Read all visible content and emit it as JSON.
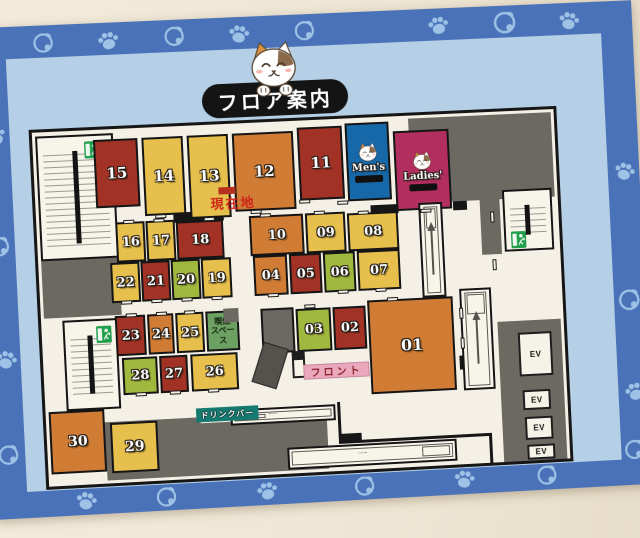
{
  "labels": {
    "title": "フロア案内",
    "current_location": "現在地",
    "front_desk": "フロント",
    "drink_bar": "ドリンクバー",
    "smoking_lines": [
      "喫煙",
      "スペース"
    ],
    "mens": "Men's",
    "ladies": "Ladies'",
    "ev": "EV"
  },
  "palette": {
    "red": "#a33226",
    "yellow": "#e6bf4c",
    "orange": "#d07c35",
    "green": "#a0b83e",
    "smokegreen": "#6da163",
    "blue": "#1668a8",
    "magenta": "#b12e5e",
    "gray": "#6c6862",
    "black": "#161616",
    "floor": "#f4f0e5",
    "teal": "#157a70",
    "pink": "#eba8bc",
    "deco": "#9dc2e6",
    "border_blue": "#4a72b8",
    "inner_blue": "#b5d0e6",
    "current_red": "#cf2418",
    "sign_green": "#1f9e4b"
  },
  "border_icons": [
    {
      "icon": "bell-icon",
      "x": 58,
      "y": 5
    },
    {
      "icon": "paw-icon",
      "x": 122,
      "y": 6,
      "rot": -10
    },
    {
      "icon": "bell-icon",
      "x": 188,
      "y": 4
    },
    {
      "icon": "paw-icon",
      "x": 252,
      "y": 5,
      "rot": 8
    },
    {
      "icon": "bell-icon",
      "x": 318,
      "y": 4
    },
    {
      "icon": "paw-icon",
      "x": 452,
      "y": 5,
      "rot": -8
    },
    {
      "icon": "bell-icon",
      "x": 518,
      "y": 3,
      "s": 27
    },
    {
      "icon": "paw-icon",
      "x": 584,
      "y": 6,
      "rot": 10
    },
    {
      "icon": "paw-icon",
      "x": 6,
      "y": 96,
      "rot": -20
    },
    {
      "icon": "bell-icon",
      "x": 5,
      "y": 205
    },
    {
      "icon": "paw-icon",
      "x": 6,
      "y": 318,
      "rot": 15
    },
    {
      "icon": "bell-icon",
      "x": 4,
      "y": 412
    },
    {
      "icon": "paw-icon",
      "x": 633,
      "y": 160,
      "rot": 15
    },
    {
      "icon": "bell-icon",
      "x": 631,
      "y": 288,
      "s": 26
    },
    {
      "icon": "paw-icon",
      "x": 633,
      "y": 382,
      "rot": -12
    },
    {
      "icon": "bell-icon",
      "x": 630,
      "y": 440
    },
    {
      "icon": "paw-icon",
      "x": 78,
      "y": 462,
      "rot": 12
    },
    {
      "icon": "bell-icon",
      "x": 158,
      "y": 462
    },
    {
      "icon": "paw-icon",
      "x": 258,
      "y": 462,
      "rot": -10
    },
    {
      "icon": "bell-icon",
      "x": 356,
      "y": 462
    },
    {
      "icon": "paw-icon",
      "x": 456,
      "y": 461,
      "rot": 8
    },
    {
      "icon": "bell-icon",
      "x": 540,
      "y": 461
    }
  ],
  "map": {
    "x": 51,
    "y": 103,
    "w": 522,
    "h": 352,
    "elements": [
      {
        "t": "wall",
        "n": "corridor-wall-top-right",
        "x": 415,
        "y": 3,
        "w": 104,
        "h": 85
      },
      {
        "t": "wall",
        "n": "corridor-wall-above-ladies",
        "x": 375,
        "y": 3,
        "w": 40,
        "h": 13
      },
      {
        "t": "wall",
        "n": "corridor-wall-right-strip",
        "x": 443,
        "y": 88,
        "w": 20,
        "h": 55
      },
      {
        "t": "wall",
        "n": "corridor-wall-left",
        "x": 3,
        "y": 128,
        "w": 77,
        "h": 57
      },
      {
        "t": "wall",
        "n": "corridor-wall-bottom-left",
        "x": 58,
        "y": 291,
        "w": 95,
        "h": 58
      },
      {
        "t": "wall",
        "n": "corridor-wall-bottom",
        "x": 149,
        "y": 297,
        "w": 130,
        "h": 52
      },
      {
        "t": "wall",
        "n": "elevator-hall-wall",
        "x": 455,
        "y": 211,
        "w": 64,
        "h": 141
      },
      {
        "t": "wall",
        "c": "black",
        "n": "wall-segment",
        "x": 136,
        "y": 86,
        "w": 50,
        "h": 10
      },
      {
        "t": "wall",
        "c": "black",
        "n": "wall-segment",
        "x": 333,
        "y": 88,
        "w": 28,
        "h": 9
      },
      {
        "t": "wall",
        "c": "black",
        "n": "wall-segment",
        "x": 416,
        "y": 88,
        "w": 14,
        "h": 9
      },
      {
        "t": "wall",
        "c": "black",
        "n": "wall-segment",
        "x": 415,
        "y": 243,
        "w": 14,
        "h": 14
      },
      {
        "t": "wall",
        "c": "black",
        "n": "wall-step",
        "x": 290,
        "y": 315,
        "w": 23,
        "h": 10
      },
      {
        "t": "wall",
        "c": "black",
        "n": "wall-segment",
        "x": 290,
        "y": 283,
        "w": 3,
        "h": 34
      },
      {
        "t": "wall",
        "c": "black",
        "n": "wall-segment",
        "x": 313,
        "y": 322,
        "w": 131,
        "h": 3
      },
      {
        "t": "wall",
        "c": "black",
        "n": "wall-segment",
        "x": 441,
        "y": 322,
        "w": 3,
        "h": 30
      },
      {
        "t": "stair",
        "n": "stairwell-top-left",
        "x": 3,
        "y": 4,
        "w": 77,
        "h": 124,
        "sign": {
          "x": 46,
          "y": 5
        }
      },
      {
        "t": "stair",
        "n": "stairwell-left",
        "x": 21,
        "y": 188,
        "w": 54,
        "h": 90,
        "sign": {
          "x": 31,
          "y": 5
        }
      },
      {
        "t": "stair",
        "n": "stairwell-right",
        "x": 466,
        "y": 79,
        "w": 50,
        "h": 62,
        "sign": {
          "x": 5,
          "y": 40
        }
      },
      {
        "t": "room",
        "n": "room-15",
        "label": "15",
        "c": "red",
        "x": 60,
        "y": 10,
        "w": 44,
        "h": 68,
        "fs": 15
      },
      {
        "t": "room",
        "n": "room-14",
        "label": "14",
        "c": "yellow",
        "x": 108,
        "y": 10,
        "w": 41,
        "h": 78,
        "fs": 15
      },
      {
        "t": "room",
        "n": "room-13",
        "label": "13",
        "c": "yellow",
        "x": 153,
        "y": 10,
        "w": 41,
        "h": 83,
        "fs": 15
      },
      {
        "t": "room",
        "n": "room-12",
        "label": "12",
        "c": "orange",
        "x": 198,
        "y": 10,
        "w": 61,
        "h": 78,
        "fs": 15
      },
      {
        "t": "room",
        "n": "room-11",
        "label": "11",
        "c": "red",
        "x": 263,
        "y": 7,
        "w": 45,
        "h": 73,
        "fs": 15
      },
      {
        "t": "room",
        "n": "room-mens",
        "special": "cat",
        "label": "Men's",
        "c": "blue",
        "x": 311,
        "y": 5,
        "w": 44,
        "h": 78
      },
      {
        "t": "room",
        "n": "room-ladies",
        "special": "cat",
        "label": "Ladies'",
        "c": "magenta",
        "x": 359,
        "y": 15,
        "w": 56,
        "h": 80
      },
      {
        "t": "room",
        "n": "room-16",
        "label": "16",
        "c": "yellow",
        "x": 78,
        "y": 93,
        "w": 29,
        "h": 40
      },
      {
        "t": "room",
        "n": "room-17",
        "label": "17",
        "c": "yellow",
        "x": 108,
        "y": 93,
        "w": 29,
        "h": 40
      },
      {
        "t": "room",
        "n": "room-18",
        "label": "18",
        "c": "red",
        "x": 138,
        "y": 95,
        "w": 47,
        "h": 38
      },
      {
        "t": "room",
        "n": "room-22",
        "label": "22",
        "c": "yellow",
        "x": 71,
        "y": 133,
        "w": 29,
        "h": 40
      },
      {
        "t": "room",
        "n": "room-21",
        "label": "21",
        "c": "red",
        "x": 101,
        "y": 133,
        "w": 29,
        "h": 40
      },
      {
        "t": "room",
        "n": "room-20",
        "label": "20",
        "c": "green",
        "x": 131,
        "y": 133,
        "w": 29,
        "h": 40
      },
      {
        "t": "room",
        "n": "room-19",
        "label": "19",
        "c": "yellow",
        "x": 161,
        "y": 133,
        "w": 30,
        "h": 40
      },
      {
        "t": "room",
        "n": "room-10",
        "label": "10",
        "c": "orange",
        "x": 211,
        "y": 93,
        "w": 54,
        "h": 40
      },
      {
        "t": "room",
        "n": "room-09",
        "label": "09",
        "c": "yellow",
        "x": 267,
        "y": 93,
        "w": 40,
        "h": 40
      },
      {
        "t": "room",
        "n": "room-08",
        "label": "08",
        "c": "yellow",
        "x": 309,
        "y": 95,
        "w": 51,
        "h": 38
      },
      {
        "t": "room",
        "n": "room-04",
        "label": "04",
        "c": "orange",
        "x": 213,
        "y": 133,
        "w": 34,
        "h": 40
      },
      {
        "t": "room",
        "n": "room-05",
        "label": "05",
        "c": "red",
        "x": 249,
        "y": 133,
        "w": 32,
        "h": 40
      },
      {
        "t": "room",
        "n": "room-06",
        "label": "06",
        "c": "green",
        "x": 283,
        "y": 133,
        "w": 32,
        "h": 40
      },
      {
        "t": "room",
        "n": "room-07",
        "label": "07",
        "c": "yellow",
        "x": 317,
        "y": 133,
        "w": 43,
        "h": 40
      },
      {
        "t": "room",
        "n": "room-23",
        "label": "23",
        "c": "red",
        "x": 73,
        "y": 186,
        "w": 30,
        "h": 40
      },
      {
        "t": "room",
        "n": "room-24",
        "label": "24",
        "c": "orange",
        "x": 105,
        "y": 186,
        "w": 26,
        "h": 40
      },
      {
        "t": "room",
        "n": "room-25",
        "label": "25",
        "c": "yellow",
        "x": 133,
        "y": 186,
        "w": 28,
        "h": 40
      },
      {
        "t": "room",
        "n": "smoking-area",
        "c": "smokegreen",
        "x": 163,
        "y": 186,
        "w": 33,
        "h": 40,
        "smoking": true
      },
      {
        "t": "wall",
        "n": "smoking-corner-wall",
        "x": 181,
        "y": 184,
        "w": 15,
        "h": 14
      },
      {
        "t": "room",
        "n": "room-28",
        "label": "28",
        "c": "green",
        "x": 78,
        "y": 228,
        "w": 35,
        "h": 37
      },
      {
        "t": "room",
        "n": "room-27",
        "label": "27",
        "c": "red",
        "x": 115,
        "y": 228,
        "w": 28,
        "h": 37
      },
      {
        "t": "room",
        "n": "room-26",
        "label": "26",
        "c": "yellow",
        "x": 146,
        "y": 228,
        "w": 47,
        "h": 37
      },
      {
        "t": "room",
        "n": "service-room",
        "c": "gray",
        "x": 218,
        "y": 186,
        "w": 33,
        "h": 45
      },
      {
        "t": "room",
        "n": "room-03",
        "label": "03",
        "c": "green",
        "x": 253,
        "y": 188,
        "w": 35,
        "h": 43
      },
      {
        "t": "room",
        "n": "room-02",
        "label": "02",
        "c": "red",
        "x": 290,
        "y": 188,
        "w": 33,
        "h": 43
      },
      {
        "t": "room",
        "n": "room-01",
        "label": "01",
        "c": "orange",
        "x": 325,
        "y": 183,
        "w": 86,
        "h": 94,
        "fs": 16
      },
      {
        "t": "room",
        "n": "room-30",
        "label": "30",
        "c": "orange",
        "x": 3,
        "y": 278,
        "w": 55,
        "h": 62,
        "fs": 14
      },
      {
        "t": "room",
        "n": "room-29",
        "label": "29",
        "c": "yellow",
        "x": 63,
        "y": 292,
        "w": 47,
        "h": 50,
        "fs": 14
      },
      {
        "t": "esc",
        "n": "escalator-mid",
        "x": 381,
        "y": 88,
        "w": 24,
        "h": 95,
        "dir": "up"
      },
      {
        "t": "esc",
        "n": "escalator-right",
        "x": 418,
        "y": 176,
        "w": 32,
        "h": 102,
        "dir": "up"
      },
      {
        "t": "esc",
        "n": "escalator-bottom-upper",
        "x": 183,
        "y": 285,
        "w": 105,
        "h": 16,
        "dir": "left"
      },
      {
        "t": "esc",
        "n": "escalator-bottom-lower",
        "x": 238,
        "y": 326,
        "w": 170,
        "h": 22,
        "dir": "right"
      },
      {
        "t": "ev",
        "n": "elevator-1",
        "x": 475,
        "y": 223,
        "w": 34,
        "h": 44
      },
      {
        "t": "ev",
        "n": "elevator-2",
        "x": 477,
        "y": 281,
        "w": 28,
        "h": 20
      },
      {
        "t": "ev",
        "n": "elevator-3",
        "x": 478,
        "y": 308,
        "w": 28,
        "h": 23
      },
      {
        "t": "ev",
        "n": "elevator-4",
        "x": 479,
        "y": 336,
        "w": 28,
        "h": 15
      },
      {
        "t": "counter",
        "n": "front-counter",
        "x": 212,
        "y": 222,
        "w": 26,
        "h": 42
      },
      {
        "t": "machine",
        "n": "kiosk-machine",
        "x": 247,
        "y": 230,
        "w": 13,
        "h": 27
      },
      {
        "t": "label",
        "n": "drink-bar-label",
        "key": "drink_bar",
        "cls": "lab-drink",
        "x": 149,
        "y": 282,
        "w": 62,
        "h": 14
      },
      {
        "t": "label",
        "n": "front-desk-label",
        "key": "front_desk",
        "cls": "lab-front",
        "x": 258,
        "y": 244,
        "w": 66,
        "h": 15
      },
      {
        "t": "marker",
        "n": "current-location-marker",
        "x": 182,
        "y": 63,
        "w": 17,
        "h": 7
      },
      {
        "t": "label",
        "n": "current-location-label",
        "key": "current_location",
        "cls": "lab-genzai",
        "x": 168,
        "y": 70,
        "w": 56,
        "h": 16
      },
      {
        "t": "notch",
        "n": "door-notch",
        "x": 118,
        "y": 87
      },
      {
        "t": "notch",
        "n": "door-notch",
        "x": 166,
        "y": 92
      },
      {
        "t": "notch",
        "n": "door-notch",
        "x": 213,
        "y": 87
      },
      {
        "t": "notch",
        "n": "door-notch",
        "x": 262,
        "y": 79
      },
      {
        "t": "notch",
        "n": "door-notch",
        "x": 300,
        "y": 82
      },
      {
        "t": "notch",
        "n": "door-notch",
        "x": 383,
        "y": 94
      },
      {
        "t": "notch",
        "n": "door-notch",
        "x": 86,
        "y": 91
      },
      {
        "t": "notch",
        "n": "door-notch",
        "x": 116,
        "y": 91
      },
      {
        "t": "notch",
        "n": "door-notch",
        "x": 80,
        "y": 171
      },
      {
        "t": "notch",
        "n": "door-notch",
        "x": 110,
        "y": 171
      },
      {
        "t": "notch",
        "n": "door-notch",
        "x": 140,
        "y": 171
      },
      {
        "t": "notch",
        "n": "door-notch",
        "x": 170,
        "y": 171
      },
      {
        "t": "notch",
        "n": "door-notch",
        "x": 222,
        "y": 91
      },
      {
        "t": "notch",
        "n": "door-notch",
        "x": 276,
        "y": 91
      },
      {
        "t": "notch",
        "n": "door-notch",
        "x": 320,
        "y": 93
      },
      {
        "t": "notch",
        "n": "door-notch",
        "x": 226,
        "y": 171
      },
      {
        "t": "notch",
        "n": "door-notch",
        "x": 296,
        "y": 171
      },
      {
        "t": "notch",
        "n": "door-notch",
        "x": 334,
        "y": 171
      },
      {
        "t": "notch",
        "n": "door-notch",
        "x": 84,
        "y": 184
      },
      {
        "t": "notch",
        "n": "door-notch",
        "x": 114,
        "y": 184
      },
      {
        "t": "notch",
        "n": "door-notch",
        "x": 142,
        "y": 184
      },
      {
        "t": "notch",
        "n": "door-notch",
        "x": 90,
        "y": 263
      },
      {
        "t": "notch",
        "n": "door-notch",
        "x": 124,
        "y": 263
      },
      {
        "t": "notch",
        "n": "door-notch",
        "x": 162,
        "y": 263
      },
      {
        "t": "notch",
        "n": "door-notch",
        "x": 262,
        "y": 184
      },
      {
        "t": "notch",
        "n": "door-notch",
        "x": 345,
        "y": 181
      },
      {
        "t": "notch",
        "n": "door-notch",
        "x": 453,
        "y": 100,
        "v": 1
      },
      {
        "t": "notch",
        "n": "door-notch",
        "x": 453,
        "y": 148,
        "v": 1
      },
      {
        "t": "notch",
        "n": "door-notch",
        "x": 417,
        "y": 195,
        "v": 1
      },
      {
        "t": "notch",
        "n": "door-notch",
        "x": 417,
        "y": 225,
        "v": 1
      }
    ]
  }
}
